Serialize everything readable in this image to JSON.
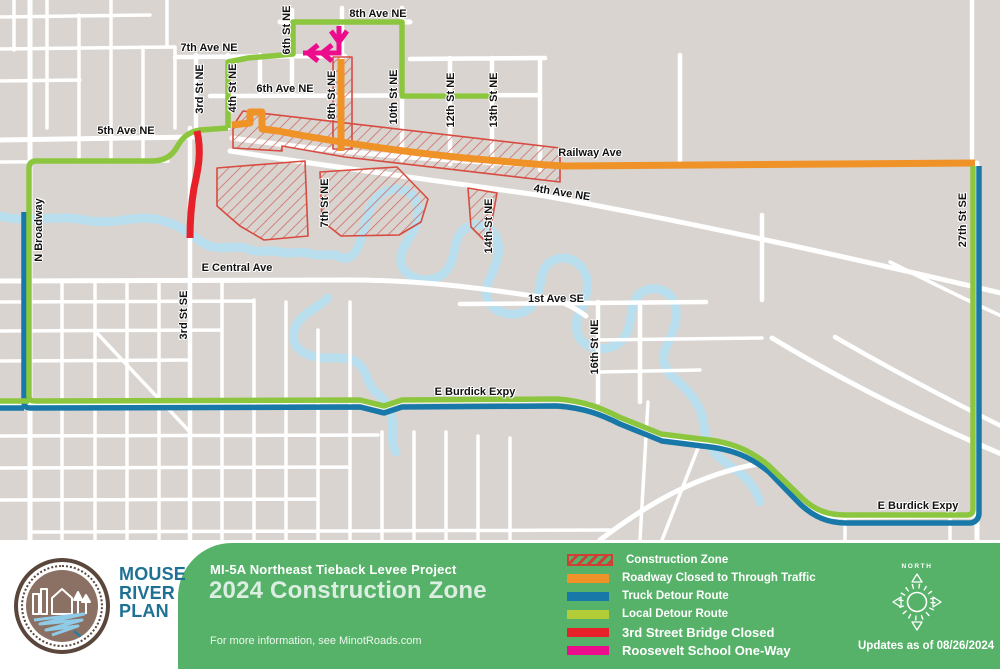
{
  "colors": {
    "map_bg": "#d9d4cf",
    "river": "#b9dfee",
    "street": "#ffffff",
    "construction_red": "#d84b41",
    "hatch_red": "#cf6f64",
    "closed_orange": "#ef9227",
    "truck_blue": "#1878a8",
    "local_green": "#8cc63e",
    "bridge_red": "#e62129",
    "oneway_pink": "#eb0d8c",
    "banner_green": "#57b269"
  },
  "map": {
    "labels": [
      {
        "text": "8th Ave NE"
      },
      {
        "text": "7th Ave NE"
      },
      {
        "text": "6th Ave NE"
      },
      {
        "text": "5th Ave NE"
      },
      {
        "text": "3rd St NE"
      },
      {
        "text": "4th St NE"
      },
      {
        "text": "6th St NE"
      },
      {
        "text": "8th St NE"
      },
      {
        "text": "10th St NE"
      },
      {
        "text": "12th St NE"
      },
      {
        "text": "13th St NE"
      },
      {
        "text": "Railway Ave"
      },
      {
        "text": "4th Ave NE"
      },
      {
        "text": "7th St NE"
      },
      {
        "text": "14th St NE"
      },
      {
        "text": "N Broadway"
      },
      {
        "text": "E Central Ave"
      },
      {
        "text": "3rd St SE"
      },
      {
        "text": "1st Ave SE"
      },
      {
        "text": "16th St NE"
      },
      {
        "text": "E Burdick Expy"
      },
      {
        "text": "E Burdick Expy"
      },
      {
        "text": "27th St SE"
      }
    ]
  },
  "banner": {
    "logo": {
      "line1": "MOUSE",
      "line2": "RIVER",
      "line3": "PLAN"
    },
    "project_title": "MI-5A Northeast Tieback Levee Project",
    "main_title": "2024 Construction Zone",
    "info_text": "For more information, see MinotRoads.com",
    "compass_label": "NORTH",
    "updated_text": "Updates as of 08/26/2024"
  },
  "legend": {
    "items": [
      {
        "label": "Construction Zone",
        "type": "hatch",
        "color": "#cf3f35",
        "bold": false
      },
      {
        "label": "Roadway Closed to Through Traffic",
        "type": "solid",
        "color": "#ef9227",
        "bold": false
      },
      {
        "label": "Truck Detour Route",
        "type": "solid",
        "color": "#1878a8",
        "bold": false
      },
      {
        "label": "Local Detour Route",
        "type": "solid",
        "color": "#b3cd39",
        "bold": false
      },
      {
        "label": "3rd Street Bridge Closed",
        "type": "solid",
        "color": "#e62129",
        "bold": true
      },
      {
        "label": "Roosevelt School One-Way",
        "type": "solid",
        "color": "#eb0d8c",
        "bold": true
      }
    ]
  }
}
